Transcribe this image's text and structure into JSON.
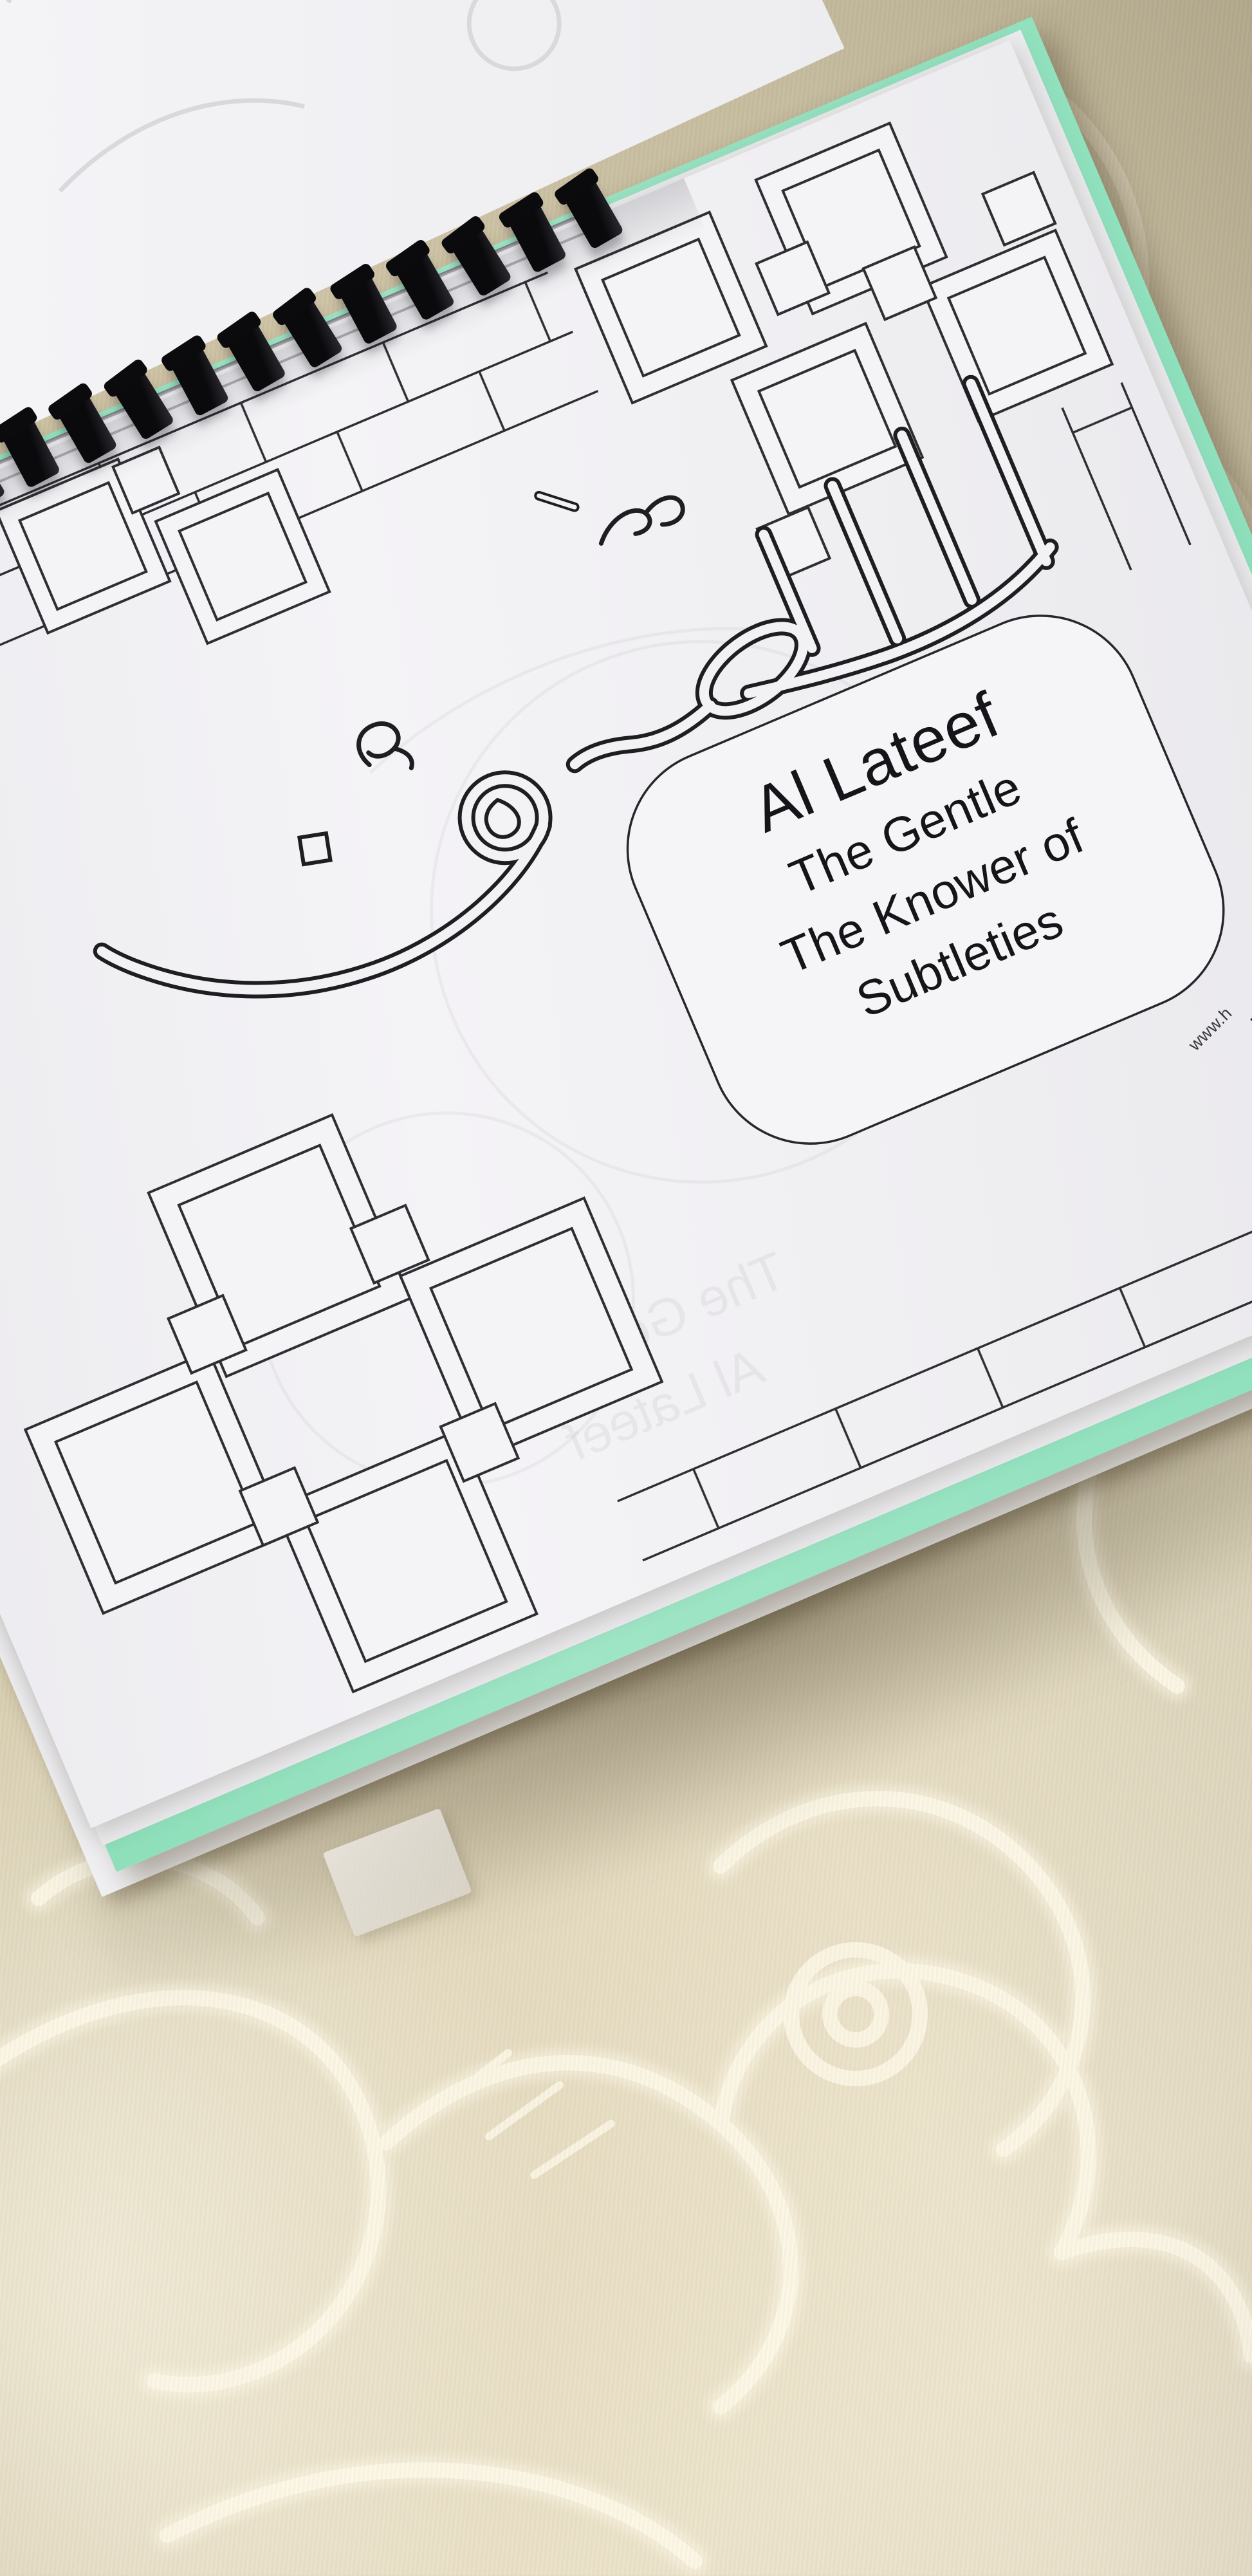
{
  "page": {
    "arabic_word": "اللَّطِيفُ",
    "name_box": {
      "title": "Al Lateef",
      "lines": [
        "The Gentle",
        "The Knower of",
        "Subtleties"
      ]
    },
    "url_text": "www.h"
  },
  "colors": {
    "page_white": "#f3f2f5",
    "cover_green": "#93e0bd",
    "fabric_beige": "#d8cdb0",
    "line_black": "#2b2b30",
    "binding_black": "#0d0d10"
  }
}
